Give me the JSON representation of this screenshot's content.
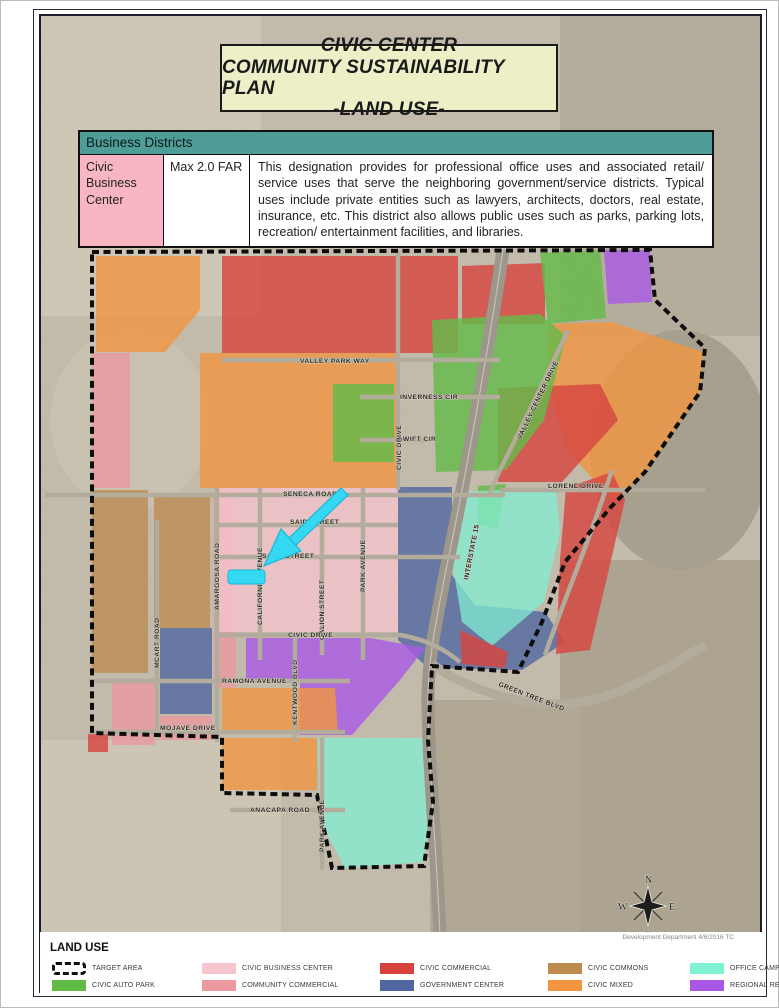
{
  "page": {
    "title_lines": [
      "CIVIC CENTER",
      "COMMUNITY SUSTAINABILITY PLAN",
      "-LAND USE-"
    ],
    "credit": "Development Department 4/6/2016 TC"
  },
  "colors": {
    "title_bg": "#edefc7",
    "table_header_bg": "#4e9d98",
    "district_cell_bg": "#f7b6c2",
    "annotation_cyan": "#35d8f2"
  },
  "table": {
    "header": "Business Districts",
    "row": {
      "district": "Civic Business Center",
      "standard": "Max 2.0 FAR",
      "description": "This designation provides for professional office uses and associated retail/ service uses that serve the neighboring government/service districts.  Typical uses include private entities such as lawyers, architects, doctors, real estate, insurance, etc.  This district also allows public uses such as parks, parking lots, recreation/ entertainment facilities, and libraries."
    }
  },
  "legend": {
    "title": "LAND USE",
    "items": [
      {
        "key": "target_area",
        "label": "TARGET AREA",
        "color": "#111111",
        "swatch": "dashed"
      },
      {
        "key": "civic_business_center",
        "label": "CIVIC BUSINESS CENTER",
        "color": "#f7c5ce",
        "swatch": "fill"
      },
      {
        "key": "civic_commercial",
        "label": "CIVIC COMMERCIAL",
        "color": "#d8423c",
        "swatch": "fill"
      },
      {
        "key": "civic_commons",
        "label": "CIVIC COMMONS",
        "color": "#bd8b50",
        "swatch": "fill"
      },
      {
        "key": "office_campus",
        "label": "OFFICE CAMPUS",
        "color": "#7ff2d4",
        "swatch": "fill"
      },
      {
        "key": "civic_auto_park",
        "label": "CIVIC AUTO PARK",
        "color": "#62bb46",
        "swatch": "fill"
      },
      {
        "key": "community_commercial",
        "label": "COMMUNITY COMMERCIAL",
        "color": "#ec99a0",
        "swatch": "fill"
      },
      {
        "key": "government_center",
        "label": "GOVERNMENT CENTER",
        "color": "#4f66a0",
        "swatch": "fill"
      },
      {
        "key": "civic_mixed",
        "label": "CIVIC MIXED",
        "color": "#f3953f",
        "swatch": "fill"
      },
      {
        "key": "regional_resource",
        "label": "REGIONAL RESOURCE",
        "color": "#a958e6",
        "swatch": "fill"
      }
    ]
  },
  "map": {
    "streets": {
      "valley_park_way": "VALLEY PARK WAY",
      "inverness_cir": "INVERNESS CIR",
      "swift_cir": "SWIFT CIR",
      "civic_drive_north": "CIVIC DRIVE",
      "valley_center_drive": "VALLEY CENTER DRIVE",
      "seneca_road": "SENECA ROAD",
      "lorene_drive": "LORENE DRIVE",
      "interstate_15": "INTERSTATE 15",
      "said_street": "SAID STREET",
      "sage_street": "SAGE STREET",
      "california_avenue": "CALIFORNIA AVENUE",
      "galion_street": "GALION STREET",
      "park_avenue_north": "PARK AVENUE",
      "civic_drive_south": "CIVIC DRIVE",
      "amargosa_road": "AMARGOSA ROAD",
      "mcart_road": "MCART ROAD",
      "ramona_avenue": "RAMONA AVENUE",
      "kentwood_blvd": "KENTWOOD BLVD",
      "mojave_drive": "MOJAVE DRIVE",
      "anacapa_road": "ANACAPA ROAD",
      "park_avenue_south": "PARK AVENUE",
      "green_tree_blvd": "GREEN TREE BLVD"
    },
    "compass": {
      "north": "N",
      "east": "E",
      "south": "S",
      "west": "W"
    }
  }
}
